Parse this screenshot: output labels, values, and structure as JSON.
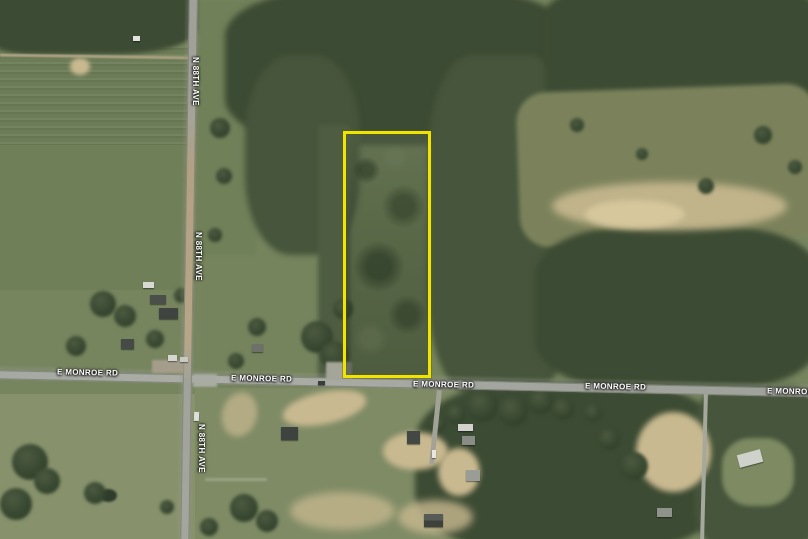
{
  "map": {
    "roads": {
      "e_monroe_rd": {
        "name": "E MONROE RD"
      },
      "n_88th_ave": {
        "name": "N 88TH AVE"
      }
    },
    "parcel": {
      "outline_color": "#f0e400"
    },
    "palette": {
      "road_gray": "#a8aba1",
      "dirt_road_tan": "#b5a485",
      "forest_dark": "#3c4b33",
      "field_light": "#87926c",
      "sand": "#c9b990",
      "label_text": "#ffffff"
    }
  }
}
